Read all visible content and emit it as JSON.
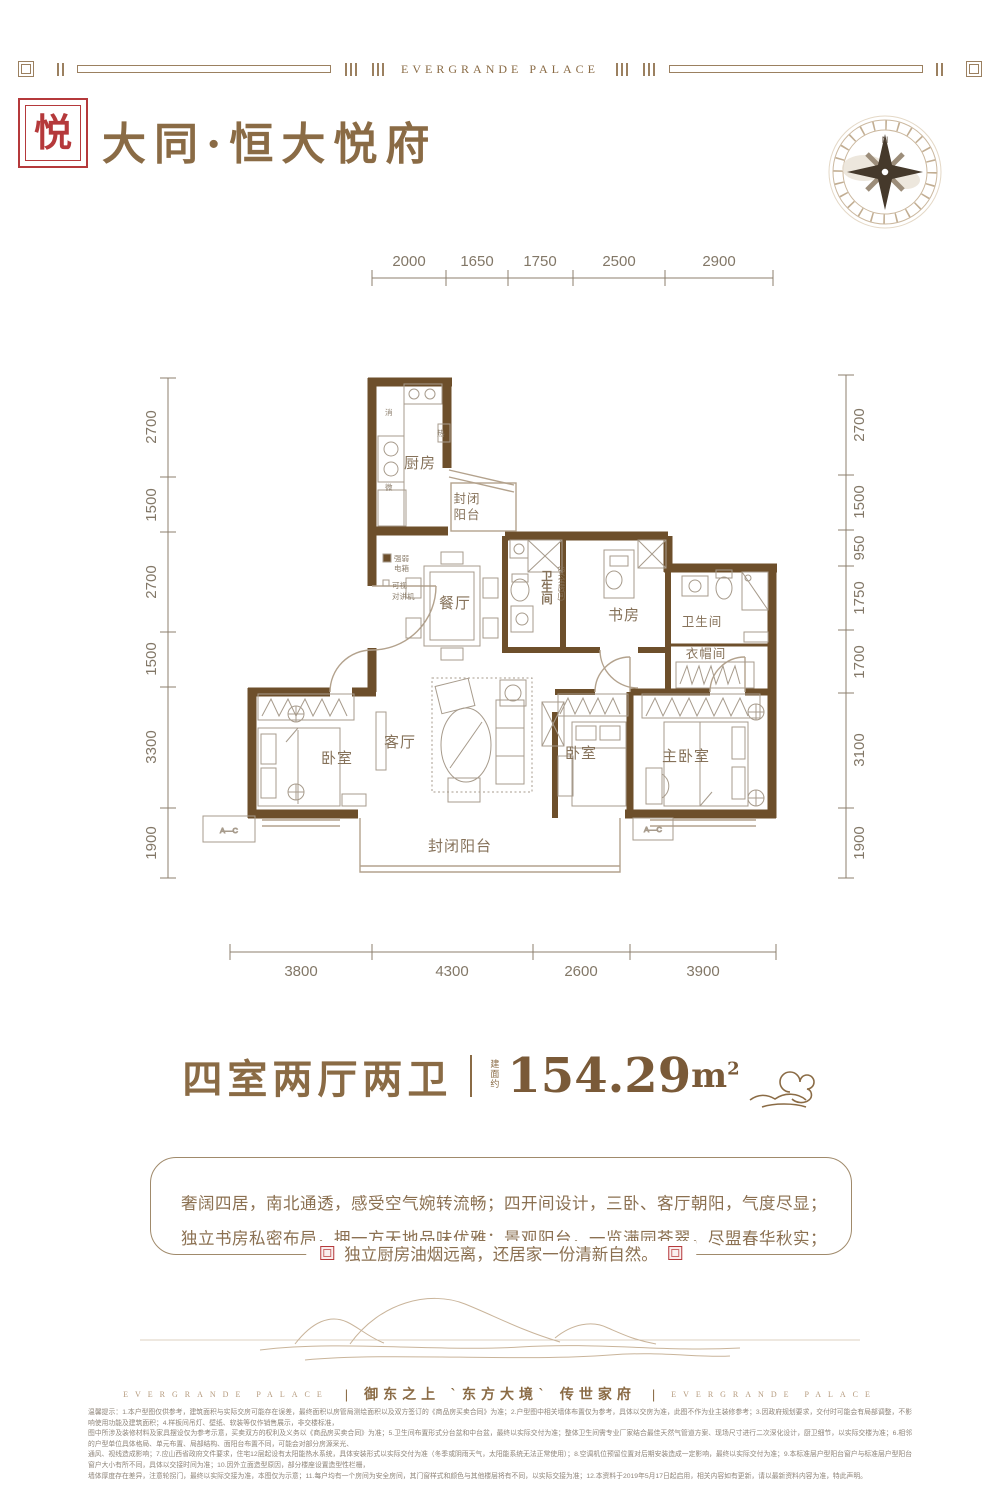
{
  "colors": {
    "brand_red": "#b5393b",
    "brand_brown": "#8a6b45",
    "wall_brown": "#6d4f2b"
  },
  "top_border": {
    "brand": "EVERGRANDE  PALACE"
  },
  "header": {
    "title": "大同·恒大悦府",
    "seal_char": "悦"
  },
  "compass": {
    "north": "N"
  },
  "floor_plan": {
    "dims_top": [
      "2000",
      "1650",
      "1750",
      "2500",
      "2900"
    ],
    "dims_left": [
      "2700",
      "1500",
      "2700",
      "1500",
      "3300",
      "1900"
    ],
    "dims_right": [
      "2700",
      "1500",
      "950",
      "1750",
      "1700",
      "3100",
      "1900"
    ],
    "dims_bottom": [
      "3800",
      "4300",
      "2600",
      "3900"
    ],
    "rooms": {
      "kitchen": "厨房",
      "balcony_top_1": "封闭",
      "balcony_top_2": "阳台",
      "dining": "餐厅",
      "bath_safe": "卫生间",
      "bath_safe_note": "(安全房间)",
      "study": "书房",
      "bath2": "卫生间",
      "cloakroom": "衣帽间",
      "bedroom_left": "卧室",
      "living": "客厅",
      "bedroom_mid": "卧室",
      "master": "主卧室",
      "balcony_bottom": "封闭阳台"
    },
    "annotations": {
      "power_box_1": "强弱",
      "power_box_2": "电箱",
      "intercom_1": "可视",
      "intercom_2": "对讲机",
      "appliance_xiao": "消",
      "appliance_re": "热",
      "appliance_wei": "微",
      "ac_left": "A—C",
      "ac_right": "A—C"
    }
  },
  "summary": {
    "layout_title": "四室两厅两卫",
    "area_prefix": "建面约",
    "area_value": "154.29",
    "area_unit": "m",
    "area_sup": "2"
  },
  "description": {
    "line1": "奢阔四居，南北通透，感受空气婉转流畅；四开间设计，三卧、客厅朝阳，气度尽显；",
    "line2": "独立书房私密布局，拥一方天地品味优雅；景观阳台，一览满园苍翠，尽盟春华秋实；",
    "line3": "独立厨房油烟远离，还居家一份清新自然。"
  },
  "footer": {
    "brand_left": "EVERGRANDE  PALACE",
    "separator": "|",
    "slogan": "御东之上 `东方大境` 传世家府",
    "brand_right": "EVERGRANDE  PALACE"
  },
  "disclaimer": {
    "line1": "温馨提示：1.本户型图仅供参考，建筑面积与实际交房可能存在误差，最终面积以房管局测绘面积以及双方签订的《商品房买卖合同》为准；2.户型图中相关墙体布置仅为参考，具体以交房为准，此图不作为业主装修参考；3.因政府规划要求，交付时可能会有局部调整，不影响使用功能及建筑面积；4.样板间吊灯、壁纸、软装等仅作销售展示，非交楼标准，",
    "line2": "图中所涉及装修材料及家具摆设仅为参考示意，买卖双方的权利及义务以《商品房买卖合同》为准；5.卫生间布置形式分台盆和中台盆，最终以实际交付为准；整体卫生间需专业厂家结合最佳天然气管道方案、现场尺寸进行二次深化设计，厨卫细节，以实际交楼为准；6.相邻的户型单位具体格局、单元布置、局部结构、面阳台布置不同，可能会对部分房源采光、",
    "line3": "通风、视线造成影响；7.应山西省政府文件要求，住宅12层起设有太阳能热水系统，具体安装形式以实际交付为准（冬季或阴雨天气，太阳能系统无法正常使用）；8.空调机位预留位置对后期安装造成一定影响，最终以实际交付为准；9.本标准层户型阳台窗户与标准层户型阳台窗户大小有所不同，具体以交接时间为准；10.因外立面造型原因，部分楼座设置造型性栏栅，",
    "line4": "墙体厚度存在差异，注意轮拐门，最终以实际交接为准，本图仅为示意；11.每户均有一个房间为安全房间，其门窗样式和颜色与其他楼层将有不同，以实际交接为准；12.本资料于2019年5月17日起启用，相关内容如有更新，请以最新资料内容为准，特此声明。"
  }
}
